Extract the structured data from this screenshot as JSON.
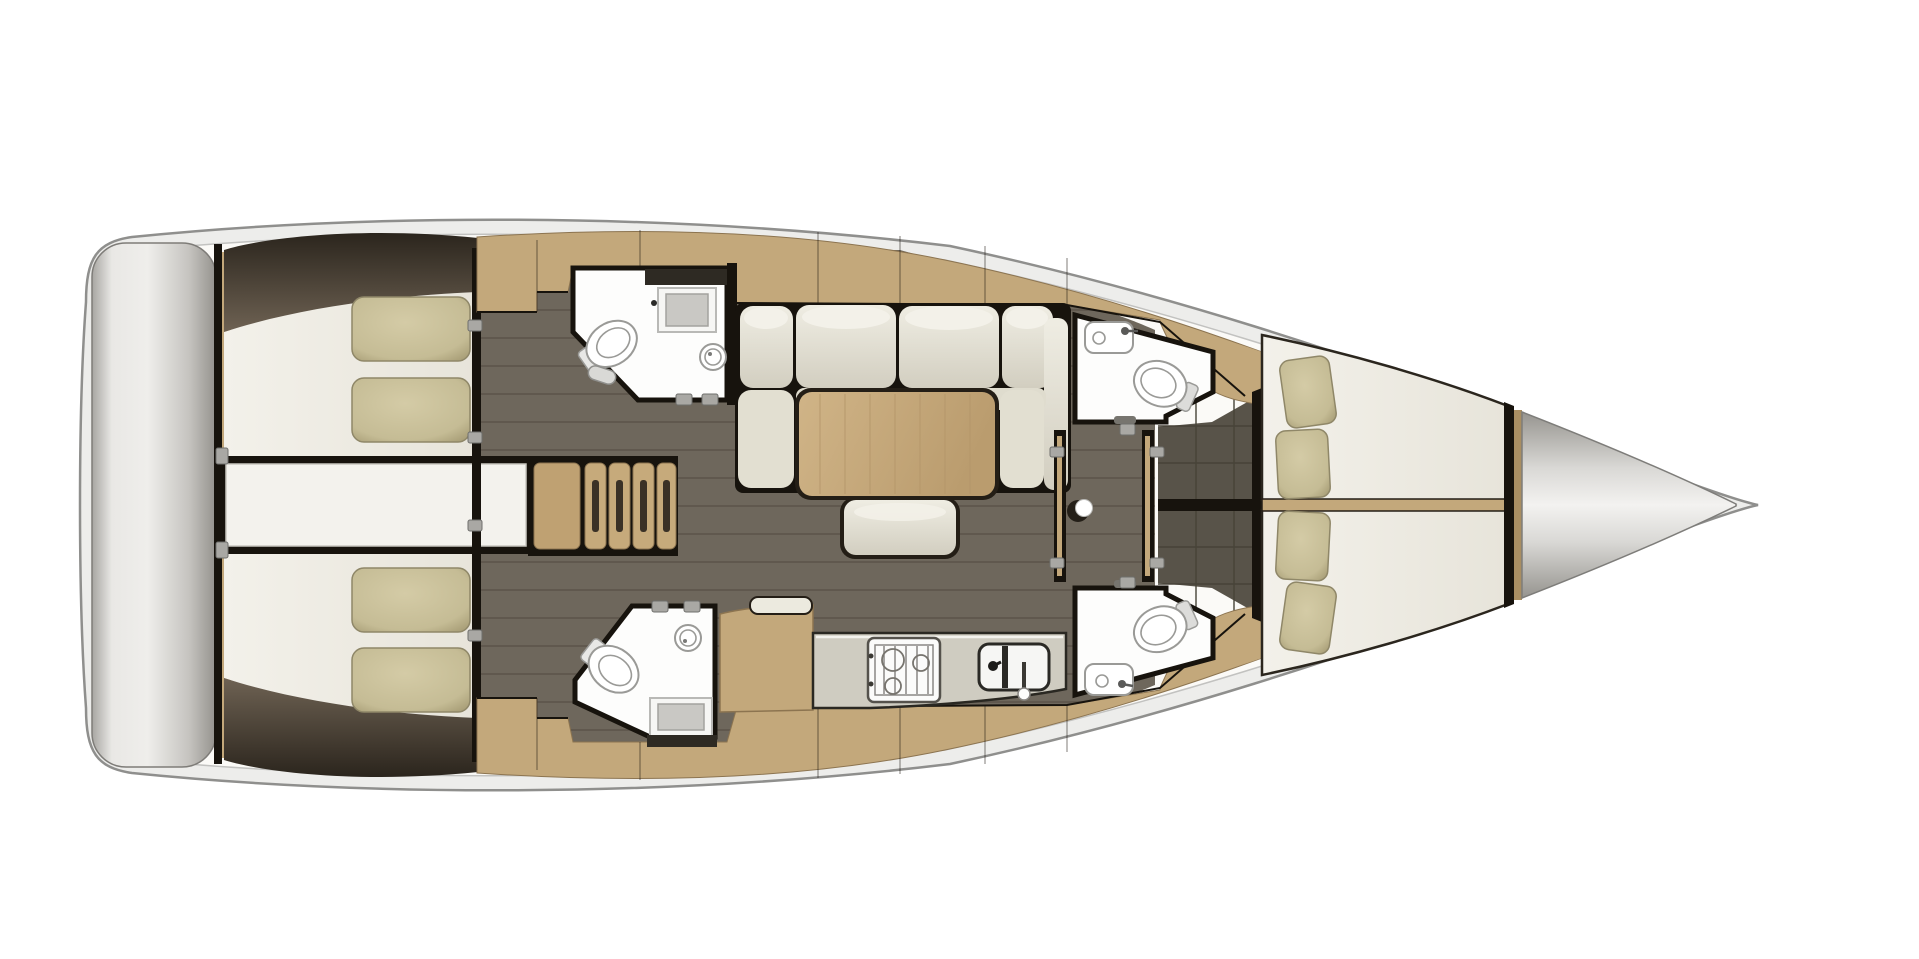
{
  "title": "Sailing yacht interior layout floor plan (top view)",
  "colors": {
    "hull_band": "#ededeb",
    "hull_stroke": "#8f8f8d",
    "hull_inner_stroke": "#c2c2c0",
    "deck": "#fbfaf7",
    "dark_wall": "#17130d",
    "wood": "#c3a87b",
    "wood_dark": "#a98e62",
    "wood_light": "#d3bb8f",
    "floor_salon": "#6e675c",
    "plank_line": "#5b544a",
    "floor_forward": "#585349",
    "tile_line": "#474338",
    "bed": "#f1efe8",
    "room_white": "#fdfdfc",
    "pillow": "#c8bf99",
    "pillow_edge": "#8f8768",
    "cushion": "#e3e0d2",
    "cushion_light": "#f2f0e8",
    "table_wood": "#c9ad80",
    "counter": "#cfccc1",
    "fixture_line": "#9a9a97",
    "hardware": "#a9a8a4",
    "stern_mid": "#efeeeb",
    "cone_mid": "#f1f0ee",
    "wedge_dark": "#332c23",
    "wedge_light": "#6e6253"
  },
  "rooms": {
    "stern_platform": "Stern swim platform",
    "aft_cabin_port": "Aft cabin port (double berth, 2 pillows)",
    "aft_cabin_starboard": "Aft cabin starboard (double berth, 2 pillows)",
    "engine_hatch": "Engine compartment hatch between aft cabins",
    "companionway": "Companionway stairs",
    "head_aft_port": "Aft head port (toilet, round sink, shower)",
    "head_aft_starboard": "Aft head starboard (toilet, round sink, shower)",
    "salon": "Salon (L-sofa, table, bench)",
    "galley": "Galley (stove, double sink, counter)",
    "head_fwd_port": "Forward head port (toilet, sink)",
    "head_fwd_starboard": "Forward head starboard (toilet, sink)",
    "corridor": "Corridor with mast post",
    "forward_cabin": "Forward cabin V-berth (4 pillows)",
    "anchor_locker": "Bow anchor locker"
  },
  "fixtures": {
    "toilets": 4,
    "sinks": 6,
    "showers": 2,
    "stove_burners": 3,
    "sofa_back_cushions": 4,
    "aft_pillows": 4,
    "forward_pillows": 4,
    "mast_post": 1
  }
}
